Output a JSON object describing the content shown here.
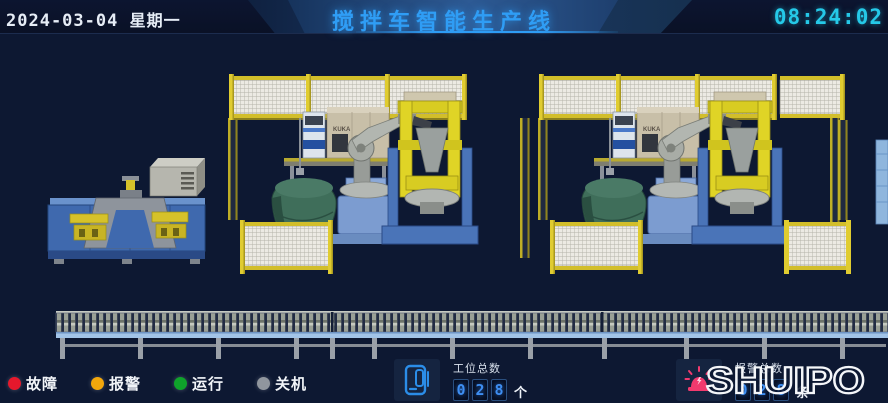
{
  "header": {
    "date": "2024-03-04",
    "weekday": "星期一",
    "title": "搅拌车智能生产线",
    "time": "08:24:02"
  },
  "legend": [
    {
      "label": "故障",
      "color": "#e5182c"
    },
    {
      "label": "报警",
      "color": "#f2a70c"
    },
    {
      "label": "运行",
      "color": "#0fa32b"
    },
    {
      "label": "关机",
      "color": "#90969e"
    }
  ],
  "counters": {
    "stations": {
      "label": "工位总数",
      "digits": [
        "0",
        "2",
        "8"
      ],
      "unit": "个"
    },
    "alarms": {
      "label": "报警总数",
      "digits": [
        "0",
        "2",
        "8"
      ],
      "unit": "条"
    }
  },
  "brand": {
    "name": "SHUIPO"
  },
  "scene": {
    "robot_brand": "KUKA"
  },
  "colors": {
    "background": "#0d1832",
    "title_accent": "#2f9df5",
    "clock": "#25c9e8",
    "fence_yellow": "#d6c22a",
    "machine_blue": "#3f69ae",
    "alarm_beacon": "#f23a6e"
  }
}
